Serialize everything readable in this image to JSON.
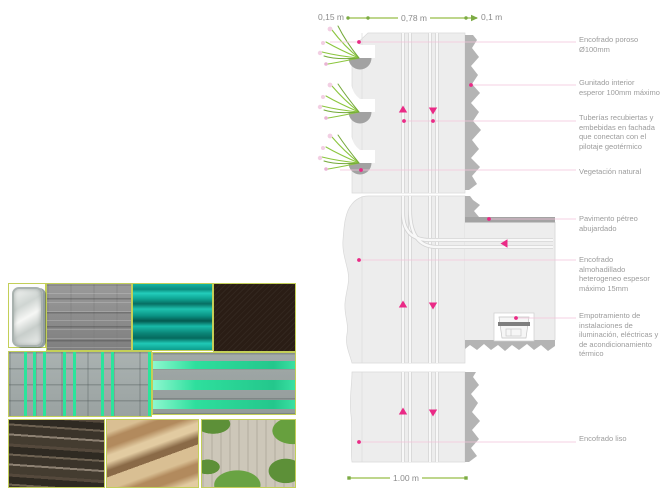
{
  "diagram": {
    "dimensions": {
      "top_left": "0,15 m",
      "top_mid": "0,78 m",
      "top_right": "0,1 m",
      "bottom": "1.00 m"
    },
    "annotations": [
      {
        "label": "Encofrado poroso Ø100mm"
      },
      {
        "label": "Gunitado interior esperor 100mm máximo"
      },
      {
        "label": "Tuberías recubiertas y embebidas en fachada que conectan con el pilotaje geotérmico"
      },
      {
        "label": "Vegetación natural"
      },
      {
        "label": "Pavimento pétreo abujardado"
      },
      {
        "label": "Encofrado almohadillado heterogeneo espesor máximo 15mm"
      },
      {
        "label": "Empotramiento de instalaciones de iluminación, eléctricas y de acondicionamiento térmico"
      },
      {
        "label": "Encofrado liso"
      }
    ],
    "colors": {
      "accent_pink": "#EA2A86",
      "leader_pink": "#F3C3DA",
      "dimension_green": "#7CAB44",
      "dimension_line_green": "#B5D17C",
      "panel_gray": "#EDEDED",
      "shotcrete_gray": "#B4B4B4",
      "paving_gray": "#A3A3A3",
      "vegetation_green": "#8CC63F",
      "annotation_text_gray": "#9C9C9C",
      "material_teal": "#0FA695",
      "stripe_green": "#2BE49B"
    }
  }
}
